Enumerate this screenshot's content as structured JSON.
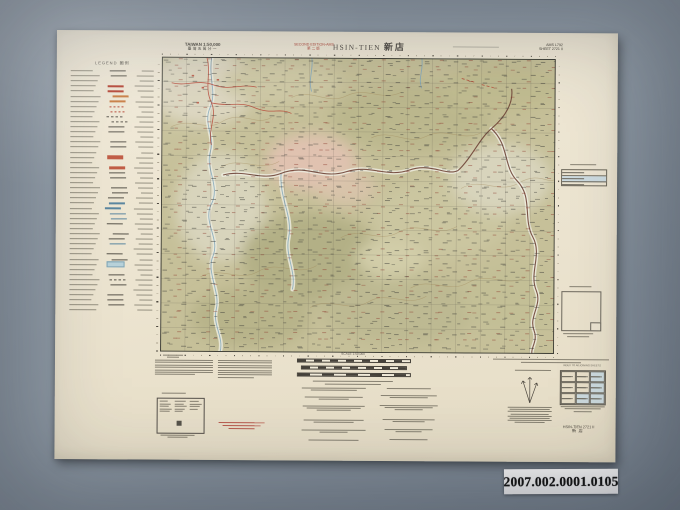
{
  "photo": {
    "catalog_label": "2007.002.0001.0105"
  },
  "sheet": {
    "header": {
      "series_line1": "TAIWAN 1:50,000",
      "series_line2": "臺灣五萬分一",
      "edition_line1": "SECOND EDITION-AMS",
      "edition_line2": "第二版",
      "title_latin": "HSIN-TIEN",
      "title_cjk": "新店",
      "sheet_ref_line1": "AMS L792",
      "sheet_ref_line2": "SHEET 2721 II"
    },
    "legend_title": "LEGEND 圖例",
    "scale_label": "SCALE 1:50,000",
    "adjoining_title": "INDEX TO ADJOINING SHEETS",
    "corner_id_line1": "HSIN-TIEN 2721 II",
    "corner_id_line2": "新店",
    "colors": {
      "paper": "#ece4d0",
      "terrain": "#c6c099",
      "grid_line": "#4c473f",
      "water": "#86aabb",
      "river_dark": "#6f4437",
      "road_red": "#b5402f",
      "clearing_pink": "#e0c2b0",
      "background_gray": "#8e99a4"
    }
  }
}
